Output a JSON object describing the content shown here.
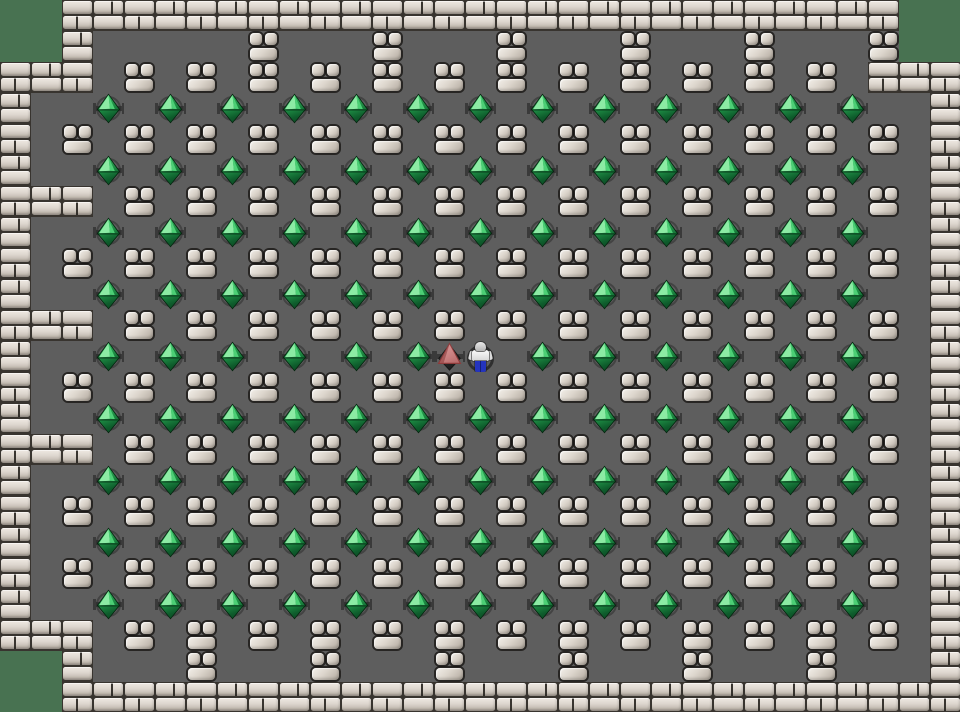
{
  "meta": {
    "app": "sokoban-style-puzzle-game",
    "view": "level-board",
    "visible_text": []
  },
  "board": {
    "cols": 31,
    "rows": 23,
    "tile_size_px": 31,
    "legend": {
      "G": "outside-green-background",
      "B": "brick-wall",
      "C": "stone-cluster",
      "D": "emerald-gem",
      "Y": "red-pyramid",
      "P": "player-character",
      ".": "floor"
    },
    "rows_map": [
      "GGBBBBBBBBBBBBBBBBBBBBBBBBBBBGG",
      "GGB.....C...C...C...C...C...CGG",
      "BBB.C.C.C.C.C.C.C.C.C.C.C.C.BBB",
      "B..D.D.D.D.D.D.D.D.D.D.D.D.D..B",
      "B.C.C.C.C.C.C.C.C.C.C.C.C.C.C.B",
      "B..D.D.D.D.D.D.D.D.D.D.D.D.D..B",
      "BBB.C.C.C.C.C.C.C.C.C.C.C.C.C.B",
      "B..D.D.D.D.D.D.D.D.D.D.D.D.D..B",
      "B.C.C.C.C.C.C.C.C.C.C.C.C.C.C.B",
      "B..D.D.D.D.D.D.D.D.D.D.D.D.D..B",
      "BBB.C.C.C.C.C.C.C.C.C.C.C.C.C.B",
      "B..D.D.D.D.D.DYP.D.D.D.D.D.D..B",
      "B.C.C.C.C.C.C.C.C.C.C.C.C.C.C.B",
      "B..D.D.D.D.D.D.D.D.D.D.D.D.D..B",
      "BBB.C.C.C.C.C.C.C.C.C.C.C.C.C.B",
      "B..D.D.D.D.D.D.D.D.D.D.D.D.D..B",
      "B.C.C.C.C.C.C.C.C.C.C.C.C.C.C.B",
      "B..D.D.D.D.D.D.D.D.D.D.D.D.D..B",
      "B.C.C.C.C.C.C.C.C.C.C.C.C.C.C.B",
      "B..D.D.D.D.D.D.D.D.D.D.D.D.D..B",
      "BBB.C.C.C.C.C.C.C.C.C.C.C.C.C.B",
      "GGB...C...C...C...C...C...C...B",
      "GGBBBBBBBBBBBBBBBBBBBBBBBBBBBBB"
    ]
  },
  "entities": {
    "player": {
      "col": 15,
      "row": 11,
      "appearance": "white shirt, blue pants, gray cap, dark ring behind"
    },
    "red_pyramid": {
      "col": 14,
      "row": 11
    },
    "counts": {
      "emerald_gems": 116,
      "stone_clusters": 146,
      "brick_wall_tiles": 109
    }
  },
  "palette": {
    "outside_green": "#487251",
    "floor_gray": "#5e5e5e",
    "mortar": "#38342f",
    "brick_light": "#efe9e2",
    "brick_dark": "#a59d93",
    "stone_light": "#f3f0ea",
    "stone_dark": "#a69e94",
    "gem_highlight": "#8ceba4",
    "gem_mid": "#1d8a43",
    "gem_dark": "#0a3f1e",
    "socket_gray": "#3a3a3a",
    "pyramid_light": "#e0a3a3",
    "pyramid_edge": "#8e3b3b",
    "player_pants": "#2434bd",
    "player_shirt": "#f2f2f2"
  }
}
